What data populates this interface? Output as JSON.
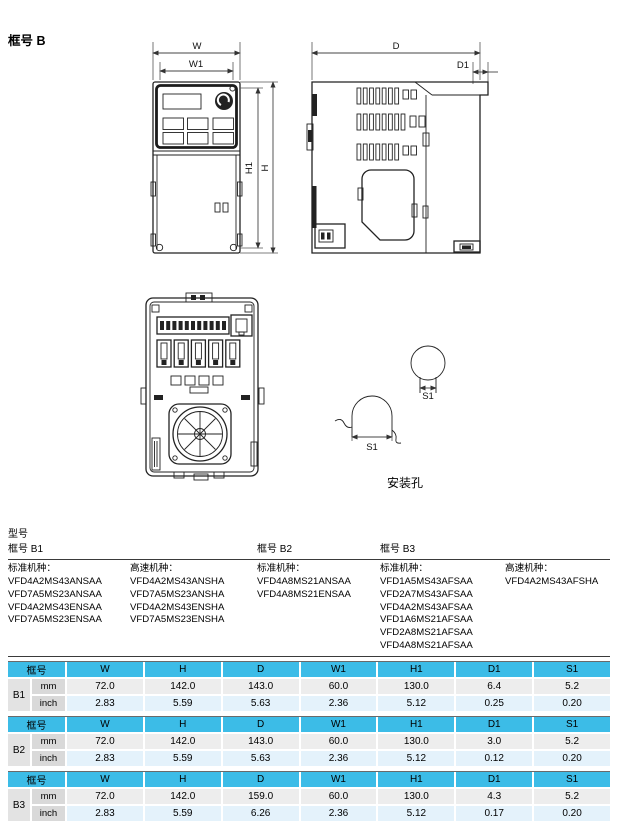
{
  "title": "框号 B",
  "dims": {
    "w": "W",
    "w1": "W1",
    "h": "H",
    "h1": "H1",
    "d": "D",
    "d1": "D1",
    "s1": "S1"
  },
  "mounting": {
    "caption": "安装孔"
  },
  "models": {
    "heading": "型号",
    "frames": [
      {
        "label": "框号 B1"
      },
      {
        "label": "框号 B2"
      },
      {
        "label": "框号 B3"
      }
    ],
    "columns": [
      {
        "label": "标准机种：",
        "items": [
          "VFD4A2MS43ANSAA",
          "VFD7A5MS23ANSAA",
          "VFD4A2MS43ENSAA",
          "VFD7A5MS23ENSAA"
        ]
      },
      {
        "label": "高速机种：",
        "items": [
          "VFD4A2MS43ANSHA",
          "VFD7A5MS23ANSHA",
          "VFD4A2MS43ENSHA",
          "VFD7A5MS23ENSHA"
        ]
      },
      {
        "label": "标准机种：",
        "items": [
          "VFD4A8MS21ANSAA",
          "VFD4A8MS21ENSAA"
        ]
      },
      {
        "label": "标准机种：",
        "items": [
          "VFD1A5MS43AFSAA",
          "VFD2A7MS43AFSAA",
          "VFD4A2MS43AFSAA",
          "VFD1A6MS21AFSAA",
          "VFD2A8MS21AFSAA",
          "VFD4A8MS21AFSAA"
        ]
      },
      {
        "label": "高速机种：",
        "items": [
          "VFD4A2MS43AFSHA"
        ]
      }
    ]
  },
  "table": {
    "header": [
      "框号",
      "W",
      "H",
      "D",
      "W1",
      "H1",
      "D1",
      "S1"
    ],
    "units": [
      "mm",
      "inch"
    ],
    "rows": [
      {
        "frame": "B1",
        "mm": [
          "72.0",
          "142.0",
          "143.0",
          "60.0",
          "130.0",
          "6.4",
          "5.2"
        ],
        "inch": [
          "2.83",
          "5.59",
          "5.63",
          "2.36",
          "5.12",
          "0.25",
          "0.20"
        ]
      },
      {
        "frame": "B2",
        "mm": [
          "72.0",
          "142.0",
          "143.0",
          "60.0",
          "130.0",
          "3.0",
          "5.2"
        ],
        "inch": [
          "2.83",
          "5.59",
          "5.63",
          "2.36",
          "5.12",
          "0.12",
          "0.20"
        ]
      },
      {
        "frame": "B3",
        "mm": [
          "72.0",
          "142.0",
          "159.0",
          "60.0",
          "130.0",
          "4.3",
          "5.2"
        ],
        "inch": [
          "2.83",
          "5.59",
          "6.26",
          "2.36",
          "5.12",
          "0.17",
          "0.20"
        ]
      }
    ]
  },
  "colors": {
    "header_cyan": "#3CBCE7",
    "row_mm": "#EDEDED",
    "row_inch": "#E4F2FB",
    "unit_gray": "#D9D9D9",
    "frame_gray": "#E3E3E3",
    "line_dark": "#222222"
  }
}
